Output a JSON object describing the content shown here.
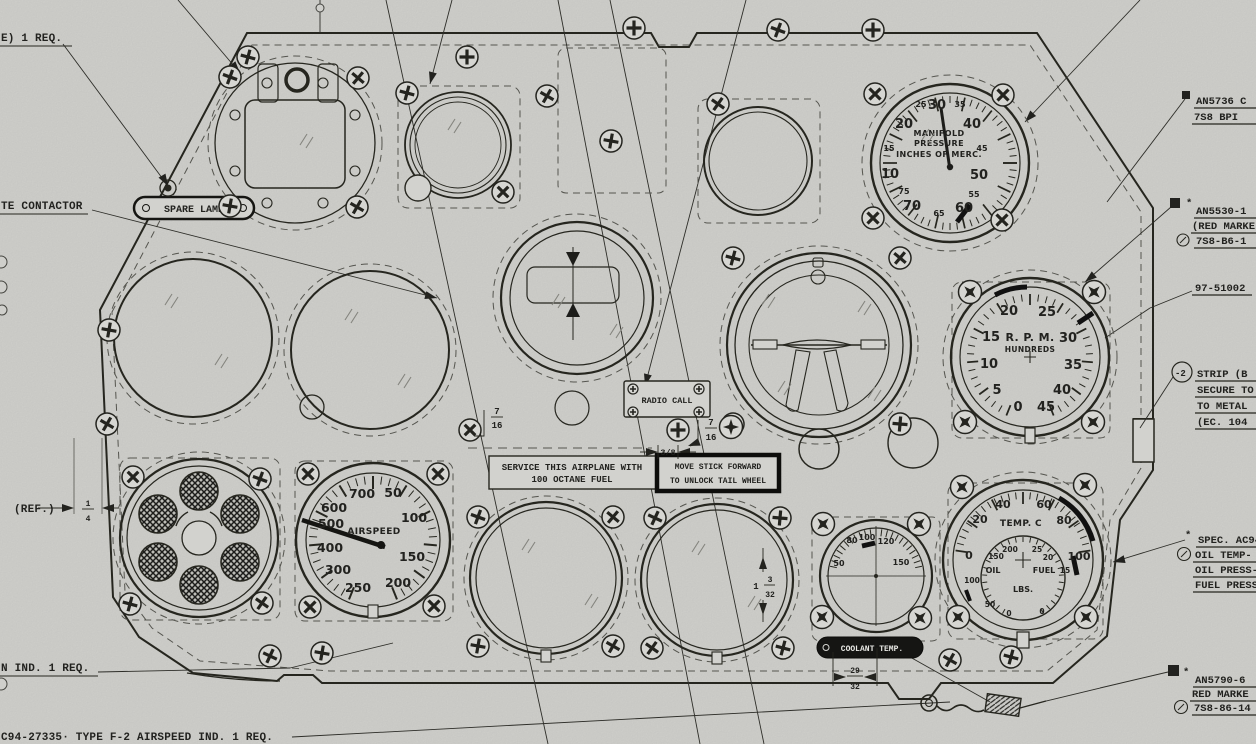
{
  "colors": {
    "paper": "#d2d2ce",
    "ink": "#22221f"
  },
  "callouts": {
    "left": {
      "req_top": "E)  1 REQ.",
      "contactor": "TE CONTACTOR",
      "ref": "(REF.)",
      "ref_num": "1",
      "ref_den": "4",
      "ind_req": "N IND.  1 REQ.",
      "airspeed_req": "C94-27335· TYPE F-2  AIRSPEED IND.  1 REQ."
    },
    "right": {
      "an5736_1": "AN5736 C",
      "an5736_2": "7S8 BPI",
      "an5530_1": "AN5530-1",
      "an5530_2": "(RED MARKE",
      "an5530_3": "7S8-B6-1",
      "part_number": "97-51002",
      "strip_ref": "-2",
      "strip_1": "STRIP (B",
      "strip_2": "SECURE TO",
      "strip_3": "TO METAL",
      "strip_4": "(EC. 104",
      "spec_1": "SPEC. AC94-2",
      "spec_2": "OIL TEMP- RE",
      "spec_3": "OIL PRESS- RE",
      "spec_4": "FUEL PRESS-",
      "an5790_1": "AN5790-6",
      "an5790_2": "RED MARKE",
      "an5790_3": "7S8-86-14"
    }
  },
  "placards": {
    "spare_lamp": "SPARE LAMP",
    "radio_call": "RADIO CALL",
    "service_1": "SERVICE THIS AIRPLANE WITH",
    "service_2": "100 OCTANE FUEL",
    "stick_1": "MOVE STICK FORWARD",
    "stick_2": "TO UNLOCK TAIL WHEEL",
    "coolant": "COOLANT TEMP."
  },
  "gauges": {
    "manifold": {
      "title_1": "MANIFOLD",
      "title_2": "PRESSURE",
      "title_3": "INCHES OF MERC.",
      "major": [
        "10",
        "20",
        "30",
        "40",
        "50",
        "60",
        "70"
      ],
      "minor": [
        "15",
        "25",
        "35",
        "45",
        "55",
        "65",
        "75"
      ]
    },
    "rpm": {
      "title_1": "R. P. M.",
      "title_2": "HUNDREDS",
      "numbers": [
        "0",
        "5",
        "10",
        "15",
        "20",
        "25",
        "30",
        "35",
        "40",
        "45"
      ]
    },
    "airspeed": {
      "title": "AIRSPEED",
      "numbers": [
        "50",
        "100",
        "150",
        "200",
        "250",
        "300",
        "400",
        "500",
        "600",
        "700"
      ]
    },
    "coolant": {
      "numbers": [
        "50",
        "80",
        "100",
        "120",
        "150"
      ]
    },
    "engine": {
      "title": "TEMP. C",
      "temp_numbers": [
        "0",
        "20",
        "40",
        "60",
        "80",
        "100"
      ],
      "oil_label": "OIL",
      "fuel_label": "FUEL",
      "lbs_label": "LBS.",
      "oil_numbers": [
        "200",
        "150",
        "100",
        "50",
        "0"
      ],
      "fuel_numbers": [
        "25",
        "20",
        "15",
        "0"
      ]
    }
  },
  "dims": {
    "a_num": "7",
    "a_den": "16",
    "b_num": "7",
    "b_den": "16",
    "c": "3/8",
    "d_whole": "1",
    "d_num": "3",
    "d_den": "32",
    "e_num": "29",
    "e_den": "32"
  },
  "misc": {
    "asterisk": "*"
  }
}
